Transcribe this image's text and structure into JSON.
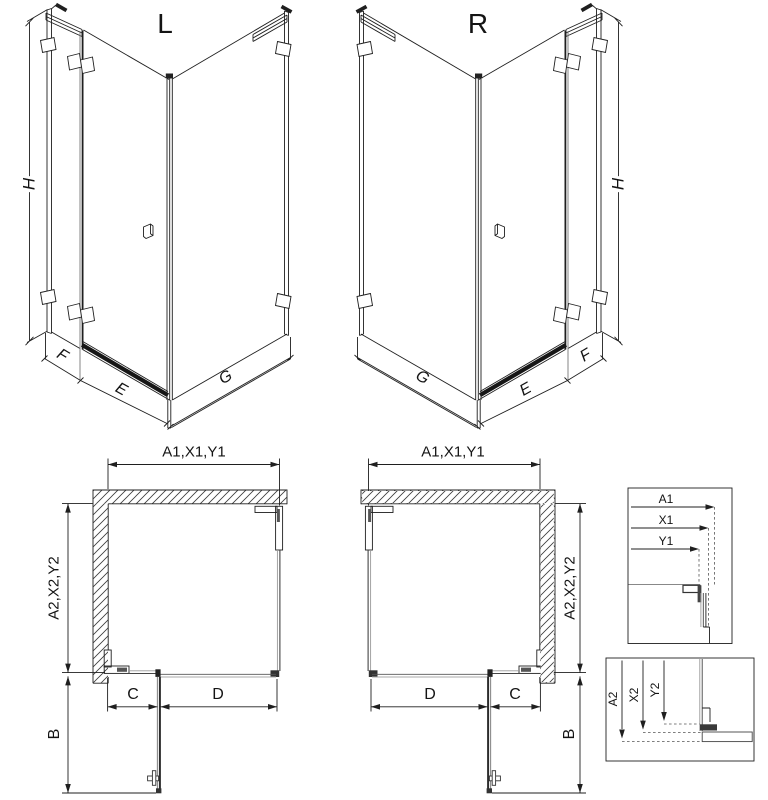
{
  "drawing": {
    "iso_left": {
      "title": "L",
      "height_label": "H",
      "fixed_panel_label": "F",
      "door_label": "E",
      "side_panel_label": "G"
    },
    "iso_right": {
      "title": "R",
      "height_label": "H",
      "fixed_panel_label": "F",
      "door_label": "E",
      "side_panel_label": "G"
    },
    "plan_left": {
      "width_label": "A1,X1,Y1",
      "depth_label": "A2,X2,Y2",
      "fixed_segment_label": "C",
      "opening_label": "D",
      "door_swing_label": "B"
    },
    "plan_right": {
      "width_label": "A1,X1,Y1",
      "depth_label": "A2,X2,Y2",
      "fixed_segment_label": "C",
      "opening_label": "D",
      "door_swing_label": "B"
    },
    "detail_width": {
      "labels": [
        "A1",
        "X1",
        "Y1"
      ]
    },
    "detail_depth": {
      "labels": [
        "A2",
        "X2",
        "Y2"
      ]
    }
  },
  "colors": {
    "line": "#1f1f1f",
    "glass_line": "#8a8a8a",
    "background": "#ffffff"
  }
}
